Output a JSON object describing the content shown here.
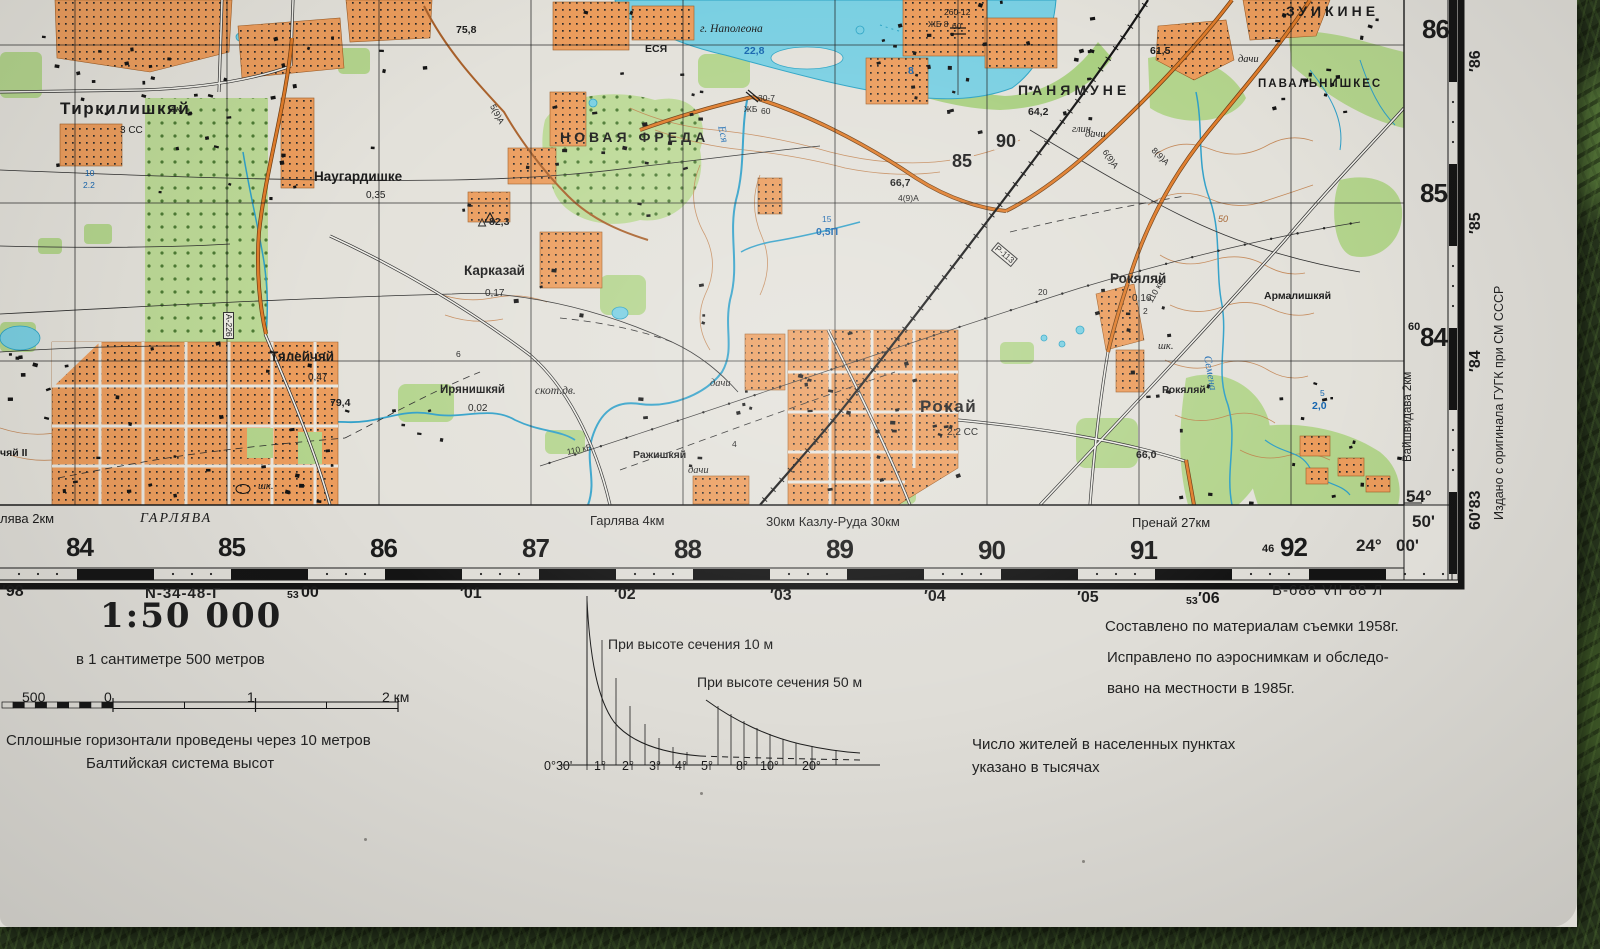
{
  "palette": {
    "paper": "#dfddd7",
    "map_paper": "#e3e1da",
    "water_fill": "#79cfe2",
    "water_line": "#2ba3c4",
    "forest_green": "#b3d48c",
    "settlement_orange": "#eb9c5c",
    "road_orange": "#e07c2a",
    "contour_brown": "#bf7b45",
    "grass_green": "#26331c",
    "ink": "#1b1b1b",
    "water_label_blue": "#1464ae"
  },
  "margins": {
    "scale_title": "1:50 000",
    "scale_subtitle": "в 1 сантиметре 500 метров",
    "contour_note": "Сплошные горизонтали проведены через 10 метров",
    "datum_note": "Балтийская система высот",
    "slope_label_10": "При высоте сечения 10 м",
    "slope_label_50": "При высоте сечения 50 м",
    "survey_note_1": "Составлено по материалам съемки 1958г.",
    "survey_note_2": "Исправлено по аэроснимкам и обследо-",
    "survey_note_3": "вано на местности в 1985г.",
    "population_note_1": "Число жителей в населенных пунктах",
    "population_note_2": "указано в тысячах",
    "sheet_designation": "N-34-48-Г",
    "print_code": "В-688 VII 88 Л",
    "edition_note": "Издано с оригинала ГУГК при СМ СССР",
    "adjacent_sheet_right": "Вайшвидава 2км",
    "corner": {
      "lat_deg": "54°",
      "lat_min": "50'",
      "lon_deg": "24°",
      "lon_min": "00'"
    }
  },
  "map": {
    "labels": [
      {
        "t": "Тиркилишкяй",
        "x": 60,
        "y": 100,
        "c": "p0"
      },
      {
        "t": "3 СС",
        "x": 120,
        "y": 126,
        "c": "sub"
      },
      {
        "t": "Наугардишке",
        "x": 314,
        "y": 170,
        "c": "p2"
      },
      {
        "t": "0,35",
        "x": 366,
        "y": 191,
        "c": "sub"
      },
      {
        "t": "НОВАЯ ФРЕДА",
        "x": 560,
        "y": 130,
        "c": "caps"
      },
      {
        "t": "Карказай",
        "x": 464,
        "y": 264,
        "c": "p2"
      },
      {
        "t": "0,17",
        "x": 485,
        "y": 289,
        "c": "sub"
      },
      {
        "t": "Тялейчяй",
        "x": 270,
        "y": 350,
        "c": "p2"
      },
      {
        "t": "0,47",
        "x": 308,
        "y": 373,
        "c": "sub"
      },
      {
        "t": "Ирянишкяй",
        "x": 440,
        "y": 385,
        "c": "p3"
      },
      {
        "t": "0,02",
        "x": 468,
        "y": 404,
        "c": "sub"
      },
      {
        "t": "скот.дв.",
        "x": 535,
        "y": 386,
        "c": "it"
      },
      {
        "t": "Ражишкяй",
        "x": 633,
        "y": 450,
        "c": "p4"
      },
      {
        "t": "дачи",
        "x": 688,
        "y": 466,
        "c": "its"
      },
      {
        "t": "дачи",
        "x": 710,
        "y": 379,
        "c": "its"
      },
      {
        "t": "дачи",
        "x": 1085,
        "y": 130,
        "c": "its"
      },
      {
        "t": "дачи",
        "x": 1238,
        "y": 55,
        "c": "its"
      },
      {
        "t": "Рокай",
        "x": 920,
        "y": 398,
        "c": "p0"
      },
      {
        "t": "2,2 СС",
        "x": 947,
        "y": 428,
        "c": "sub"
      },
      {
        "t": "ПАНЯМУНЕ",
        "x": 1018,
        "y": 83,
        "c": "caps"
      },
      {
        "t": "64,2",
        "x": 1028,
        "y": 107,
        "c": "el"
      },
      {
        "t": "ЗУИКИНЕ",
        "x": 1286,
        "y": 4,
        "c": "caps"
      },
      {
        "t": "ПАВАЛЬНИШКЕС",
        "x": 1258,
        "y": 79,
        "c": "caps2"
      },
      {
        "t": "Рокяляй",
        "x": 1110,
        "y": 272,
        "c": "p2"
      },
      {
        "t": "0,16",
        "x": 1132,
        "y": 294,
        "c": "sub"
      },
      {
        "t": "Рокяляй",
        "x": 1162,
        "y": 385,
        "c": "p4"
      },
      {
        "t": "Армалишкяй",
        "x": 1264,
        "y": 291,
        "c": "p4"
      },
      {
        "t": "г. Наполеона",
        "x": 700,
        "y": 24,
        "c": "it"
      },
      {
        "t": "22,8",
        "x": 744,
        "y": 46,
        "c": "w"
      },
      {
        "t": "ЕСЯ",
        "x": 645,
        "y": 44,
        "c": "p4"
      },
      {
        "t": "Еся",
        "x": 726,
        "y": 125,
        "c": "wi",
        "r": 78
      },
      {
        "t": "Семена",
        "x": 1212,
        "y": 355,
        "c": "wi",
        "r": 80
      },
      {
        "t": "8",
        "x": 908,
        "y": 66,
        "c": "w"
      },
      {
        "t": "75,8",
        "x": 456,
        "y": 25,
        "c": "el"
      },
      {
        "t": "61,5",
        "x": 1150,
        "y": 46,
        "c": "el"
      },
      {
        "t": "66,7",
        "x": 890,
        "y": 178,
        "c": "el"
      },
      {
        "t": "4(9)А",
        "x": 898,
        "y": 194,
        "c": "tn"
      },
      {
        "t": "66,0",
        "x": 1136,
        "y": 450,
        "c": "el"
      },
      {
        "t": "79,4",
        "x": 330,
        "y": 398,
        "c": "el"
      },
      {
        "t": "△ 82,3",
        "x": 478,
        "y": 217,
        "c": "el"
      },
      {
        "t": "глин.",
        "x": 1072,
        "y": 125,
        "c": "its"
      },
      {
        "t": "шк.",
        "x": 168,
        "y": 105,
        "c": "its"
      },
      {
        "t": "шк.",
        "x": 258,
        "y": 482,
        "c": "its"
      },
      {
        "t": "шк.",
        "x": 1158,
        "y": 342,
        "c": "its"
      },
      {
        "t": "110 кВ",
        "x": 566,
        "y": 448,
        "c": "tn",
        "r": -12
      },
      {
        "t": "110 кВ",
        "x": 1146,
        "y": 300,
        "c": "tn",
        "r": -62
      },
      {
        "t": "Р-113",
        "x": 998,
        "y": 242,
        "c": "tn box",
        "r": 40
      },
      {
        "t": "А-226",
        "x": 234,
        "y": 312,
        "c": "tn box",
        "r": 90
      },
      {
        "t": "260-12",
        "x": 944,
        "y": 8,
        "c": "tn"
      },
      {
        "t": "ЖБ 8",
        "x": 928,
        "y": 20,
        "c": "tn"
      },
      {
        "t": "60",
        "x": 952,
        "y": 22,
        "c": "tn"
      },
      {
        "t": "30-7",
        "x": 758,
        "y": 94,
        "c": "tn"
      },
      {
        "t": "ЖБ",
        "x": 744,
        "y": 105,
        "c": "tn"
      },
      {
        "t": "60",
        "x": 761,
        "y": 107,
        "c": "tn"
      },
      {
        "t": "15",
        "x": 822,
        "y": 215,
        "c": "wt"
      },
      {
        "t": "0,5П",
        "x": 816,
        "y": 227,
        "c": "w"
      },
      {
        "t": "10",
        "x": 85,
        "y": 169,
        "c": "wt"
      },
      {
        "t": "2.2",
        "x": 83,
        "y": 181,
        "c": "wt"
      },
      {
        "t": "5",
        "x": 1320,
        "y": 389,
        "c": "wt"
      },
      {
        "t": "2,0",
        "x": 1312,
        "y": 401,
        "c": "w"
      },
      {
        "t": "50",
        "x": 1218,
        "y": 215,
        "c": "ct"
      },
      {
        "t": "90",
        "x": 994,
        "y": 132,
        "c": "gi"
      },
      {
        "t": "85",
        "x": 950,
        "y": 152,
        "c": "gi"
      },
      {
        "t": "20",
        "x": 1038,
        "y": 288,
        "c": "tn"
      },
      {
        "t": "2",
        "x": 1143,
        "y": 307,
        "c": "tn"
      },
      {
        "t": "4",
        "x": 732,
        "y": 440,
        "c": "tn"
      },
      {
        "t": "6",
        "x": 456,
        "y": 350,
        "c": "tn"
      },
      {
        "t": "5(9)А",
        "x": 496,
        "y": 103,
        "c": "tn",
        "r": 62
      },
      {
        "t": "6(9)А",
        "x": 1108,
        "y": 148,
        "c": "tn",
        "r": 55
      },
      {
        "t": "8(9)А",
        "x": 1156,
        "y": 146,
        "c": "tn",
        "r": 45
      },
      {
        "t": "чяй II",
        "x": 0,
        "y": 448,
        "c": "p4"
      },
      {
        "t": "лява 2км",
        "x": 0,
        "y": 512,
        "c": "ml"
      },
      {
        "t": "ГАРЛЯВА",
        "x": 140,
        "y": 512,
        "c": "mi"
      },
      {
        "t": "Гарлява 4км",
        "x": 590,
        "y": 514,
        "c": "ml"
      },
      {
        "t": "30км Казлу-Руда 30км",
        "x": 766,
        "y": 515,
        "c": "ml"
      },
      {
        "t": "Пренай 27км",
        "x": 1132,
        "y": 516,
        "c": "ml"
      },
      {
        "t": "84",
        "x": 66,
        "y": 534,
        "c": "gn"
      },
      {
        "t": "85",
        "x": 218,
        "y": 534,
        "c": "gn"
      },
      {
        "t": "86",
        "x": 370,
        "y": 535,
        "c": "gn"
      },
      {
        "t": "87",
        "x": 522,
        "y": 535,
        "c": "gn"
      },
      {
        "t": "88",
        "x": 674,
        "y": 536,
        "c": "gn"
      },
      {
        "t": "89",
        "x": 826,
        "y": 536,
        "c": "gn"
      },
      {
        "t": "90",
        "x": 978,
        "y": 537,
        "c": "gn"
      },
      {
        "t": "91",
        "x": 1130,
        "y": 537,
        "c": "gn"
      },
      {
        "t": "46",
        "x": 1262,
        "y": 544,
        "c": "gs"
      },
      {
        "t": "92",
        "x": 1280,
        "y": 534,
        "c": "gn"
      },
      {
        "t": "86",
        "x": 1422,
        "y": 16,
        "c": "gn"
      },
      {
        "t": "85",
        "x": 1420,
        "y": 180,
        "c": "gn"
      },
      {
        "t": "60",
        "x": 1408,
        "y": 322,
        "c": "gs"
      },
      {
        "t": "84",
        "x": 1420,
        "y": 324,
        "c": "gn"
      },
      {
        "t": "′98",
        "x": 2,
        "y": 584,
        "c": "en"
      },
      {
        "t": "53",
        "x": 287,
        "y": 590,
        "c": "es"
      },
      {
        "t": "00",
        "x": 301,
        "y": 585,
        "c": "en"
      },
      {
        "t": "′01",
        "x": 460,
        "y": 586,
        "c": "en"
      },
      {
        "t": "′02",
        "x": 614,
        "y": 587,
        "c": "en"
      },
      {
        "t": "′03",
        "x": 770,
        "y": 588,
        "c": "en"
      },
      {
        "t": "′04",
        "x": 924,
        "y": 589,
        "c": "en"
      },
      {
        "t": "′05",
        "x": 1077,
        "y": 590,
        "c": "en"
      },
      {
        "t": "53",
        "x": 1186,
        "y": 596,
        "c": "es"
      },
      {
        "t": "′06",
        "x": 1198,
        "y": 591,
        "c": "en"
      },
      {
        "t": "′86",
        "x": 1468,
        "y": 72,
        "c": "en",
        "r": -90
      },
      {
        "t": "′85",
        "x": 1468,
        "y": 234,
        "c": "en",
        "r": -90
      },
      {
        "t": "′84",
        "x": 1468,
        "y": 372,
        "c": "en",
        "r": -90
      },
      {
        "t": "60′83",
        "x": 1468,
        "y": 530,
        "c": "en",
        "r": -90
      },
      {
        "t": "500",
        "x": 22,
        "y": 690,
        "c": "sb"
      },
      {
        "t": "0",
        "x": 104,
        "y": 690,
        "c": "sb"
      },
      {
        "t": "1",
        "x": 247,
        "y": 690,
        "c": "sb"
      },
      {
        "t": "2 км",
        "x": 382,
        "y": 690,
        "c": "sb"
      },
      {
        "t": "0°30'",
        "x": 544,
        "y": 760,
        "c": "sa"
      },
      {
        "t": "1°",
        "x": 594,
        "y": 760,
        "c": "sa"
      },
      {
        "t": "2°",
        "x": 622,
        "y": 760,
        "c": "sa"
      },
      {
        "t": "3°",
        "x": 649,
        "y": 760,
        "c": "sa"
      },
      {
        "t": "4°",
        "x": 675,
        "y": 760,
        "c": "sa"
      },
      {
        "t": "5°",
        "x": 701,
        "y": 760,
        "c": "sa"
      },
      {
        "t": "8°",
        "x": 736,
        "y": 760,
        "c": "sa"
      },
      {
        "t": "10°",
        "x": 760,
        "y": 760,
        "c": "sa"
      },
      {
        "t": "20°",
        "x": 802,
        "y": 760,
        "c": "sa"
      }
    ]
  }
}
